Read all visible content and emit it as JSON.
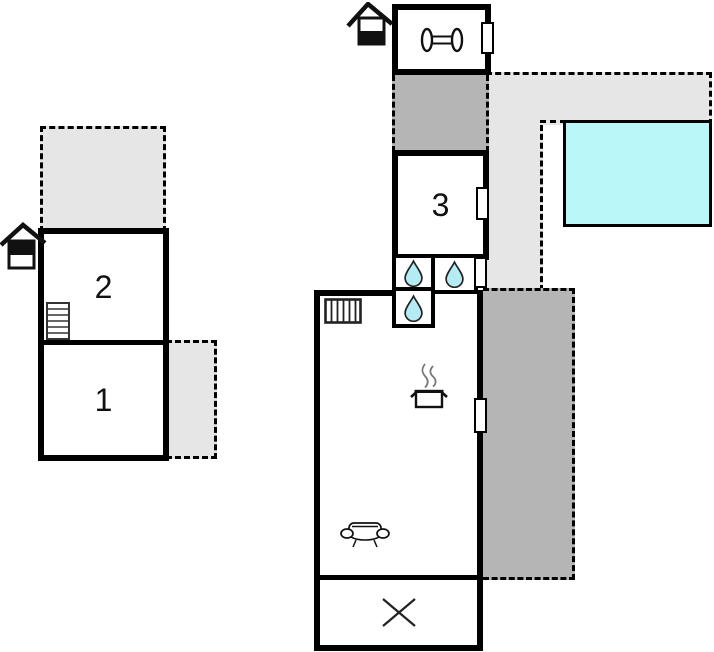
{
  "plan": {
    "title": "Holiday home floor plan",
    "rooms": {
      "room1": {
        "label": "1"
      },
      "room2": {
        "label": "2"
      },
      "room3": {
        "label": "3"
      }
    },
    "colors": {
      "wall": "#000000",
      "terrace": "#e6e6e6",
      "patio": "#b5b5b5",
      "pool": "#b9f7f8",
      "water_drop": "#b5ecf4"
    },
    "icons": {
      "entrance_top": "entrance-icon",
      "entrance_left": "entrance-icon",
      "gym": "dumbbell-icon",
      "bathroom": "water-drop-icon",
      "stairs": "stairs-icon",
      "heating": "radiator-icon",
      "kitchen": "cooking-pot-icon",
      "living": "sofa-icon",
      "excluded_area": "x-mark-icon",
      "pool": "swimming-pool"
    }
  }
}
